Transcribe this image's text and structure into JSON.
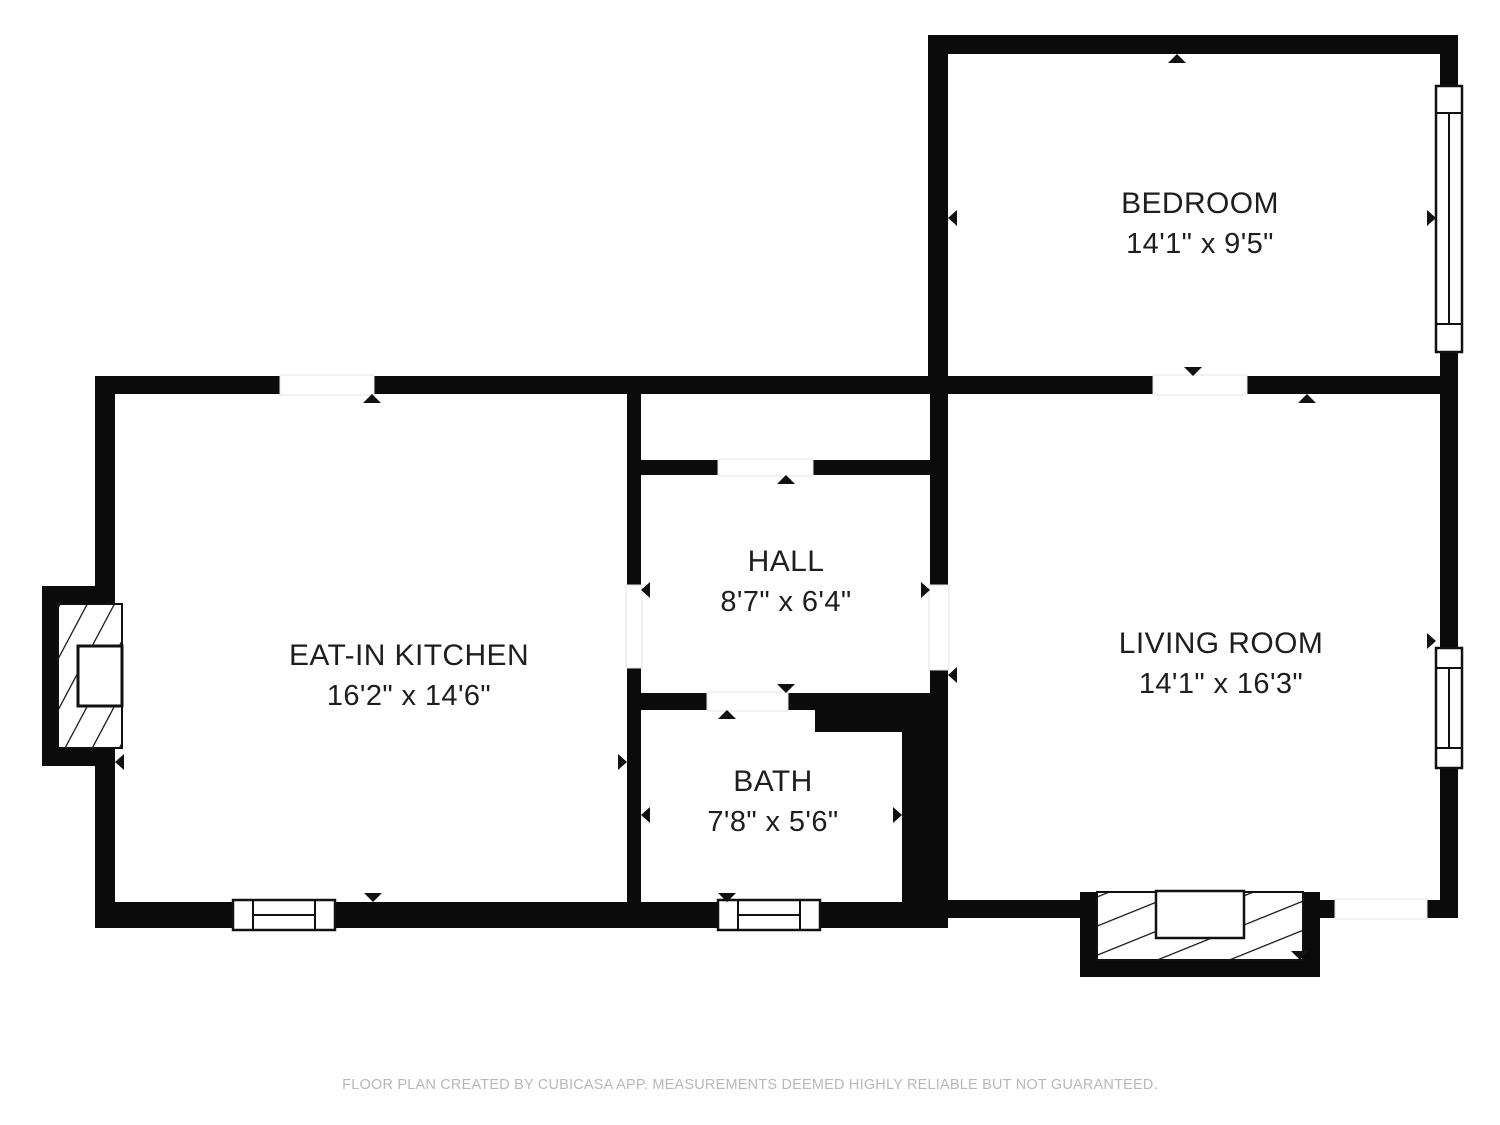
{
  "floor_plan": {
    "rooms": [
      {
        "id": "bedroom",
        "name": "BEDROOM",
        "dimensions": "14'1\" x 9'5\""
      },
      {
        "id": "eat_in_kitchen",
        "name": "EAT-IN KITCHEN",
        "dimensions": "16'2\" x 14'6\""
      },
      {
        "id": "hall",
        "name": "HALL",
        "dimensions": "8'7\" x 6'4\""
      },
      {
        "id": "living_room",
        "name": "LIVING ROOM",
        "dimensions": "14'1\" x 16'3\""
      },
      {
        "id": "bath",
        "name": "BATH",
        "dimensions": "7'8\" x 5'6\""
      }
    ],
    "footer": "FLOOR PLAN CREATED BY CUBICASA APP. MEASUREMENTS DEEMED HIGHLY RELIABLE BUT NOT GUARANTEED.",
    "colors": {
      "wall": "#0b0b0b",
      "label_text": "#1e1e1e",
      "footer_text": "#b8b8b8",
      "background": "#ffffff"
    },
    "features": {
      "windows": 4,
      "door_openings": 7,
      "chimney": "hatched chimney with firebox on left kitchen wall",
      "entry": "hatched entry stoop at bottom of living room"
    }
  }
}
